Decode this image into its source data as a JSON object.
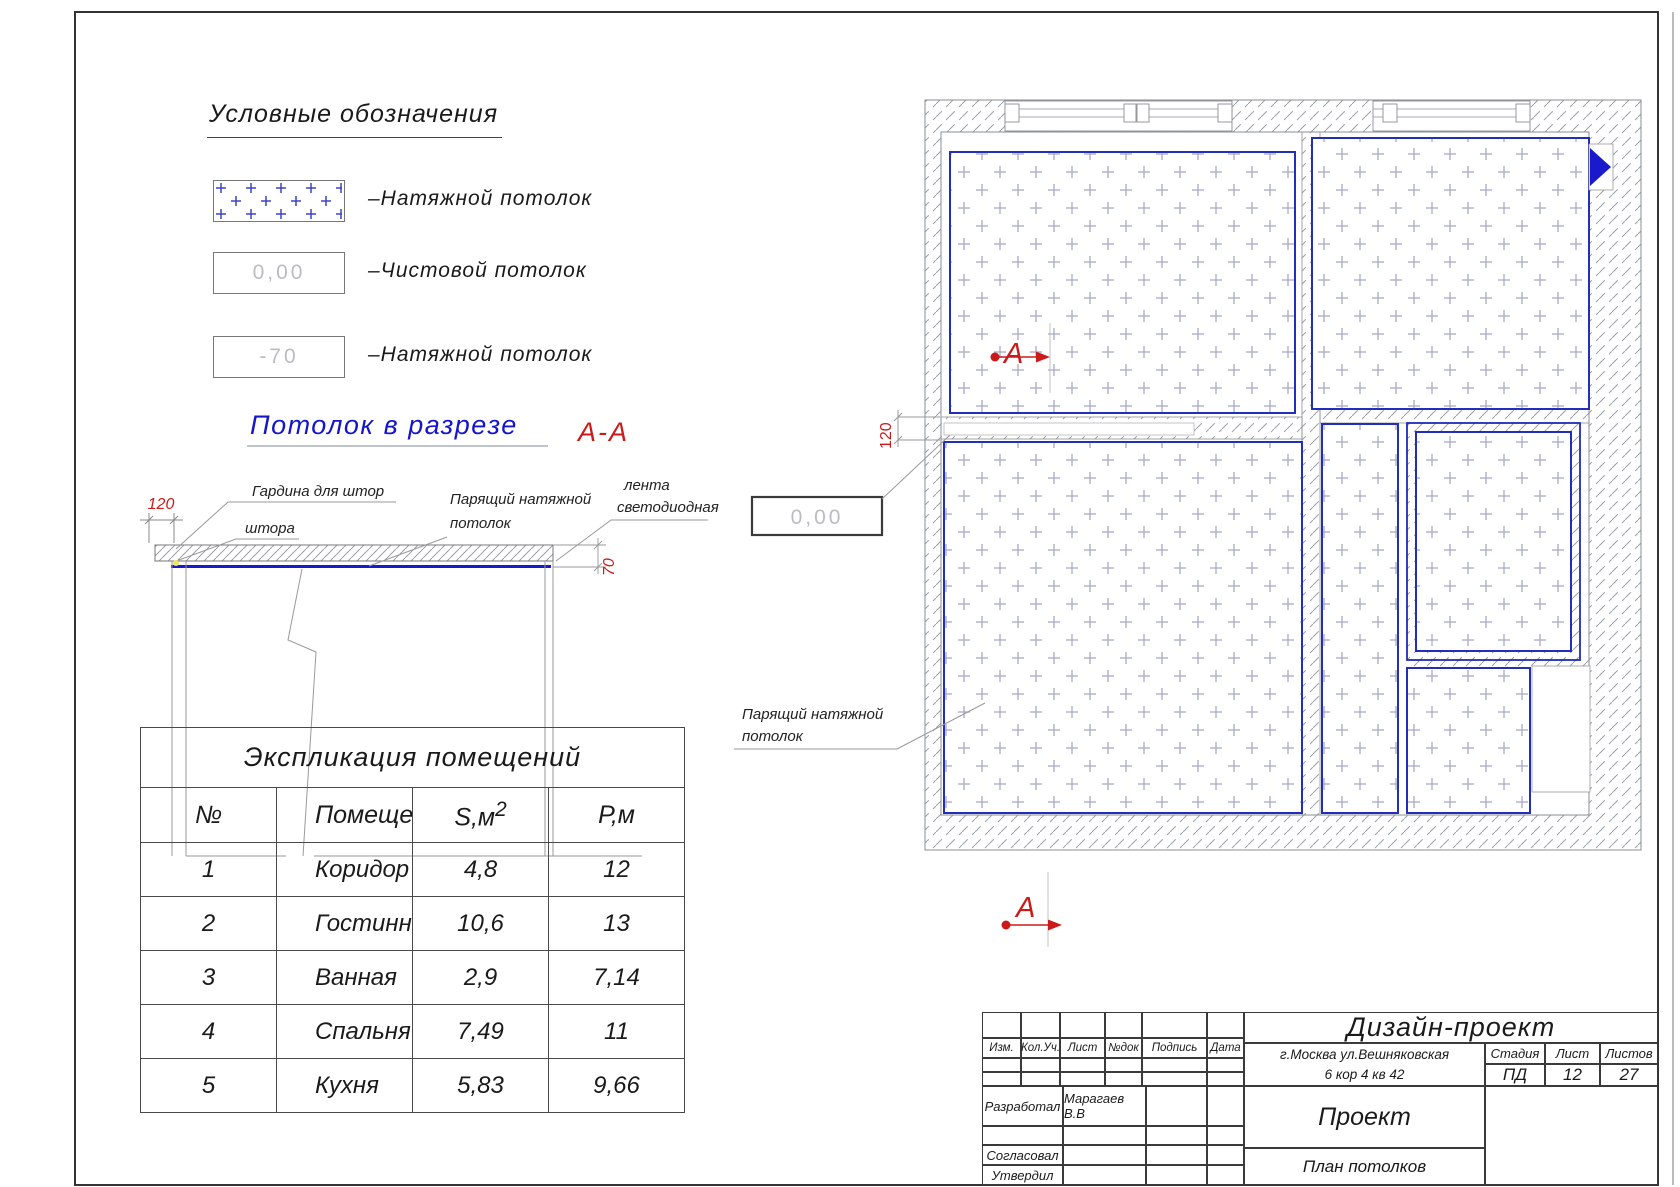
{
  "legend": {
    "title": "Условные обозначения",
    "items": [
      {
        "swatch": "plus-pattern",
        "label": "–Натяжной потолок"
      },
      {
        "swatch_text": "0,00",
        "label": "–Чистовой потолок"
      },
      {
        "swatch_text": "-70",
        "label": "–Натяжной потолок"
      }
    ]
  },
  "section": {
    "title": "Потолок в разрезе",
    "cut_label": "А-А",
    "dim_left": "120",
    "dim_right": "70",
    "labels": {
      "curtain": "Гардина для штор",
      "curtain_short": "штора",
      "floating_1": "Парящий натяжной",
      "floating_2": "потолок",
      "led_1": "лента",
      "led_2": "светодиодная"
    }
  },
  "plan": {
    "dim_gap": "120",
    "level_mark": "0,00",
    "callout_1": "Парящий натяжной",
    "callout_2": "потолок",
    "section_marker": "А"
  },
  "table": {
    "title": "Экспликация помещений",
    "headers": [
      "№",
      "Помещение",
      "S,м",
      "Р,м"
    ],
    "area_sup": "2",
    "rows": [
      [
        "1",
        "Коридор",
        "4,8",
        "12"
      ],
      [
        "2",
        "Гостинная",
        "10,6",
        "13"
      ],
      [
        "3",
        "Ванная",
        "2,9",
        "7,14"
      ],
      [
        "4",
        "Спальня",
        "7,49",
        "11"
      ],
      [
        "5",
        "Кухня",
        "5,83",
        "9,66"
      ]
    ]
  },
  "title_block": {
    "rev_cols": [
      "Изм.",
      "Кол.Уч.",
      "Лист",
      "№док",
      "Подпись",
      "Дата"
    ],
    "developed_label": "Разработал",
    "developed_by": "Марагаев В.В",
    "agreed_label": "Согласовал",
    "approved_label": "Утвердил",
    "project": "Дизайн-проект",
    "address_1": "г.Москва ул.Вешняковская",
    "address_2": "6 кор 4 кв 42",
    "stage_label": "Стадия",
    "sheet_label": "Лист",
    "sheets_label": "Листов",
    "stage": "ПД",
    "sheet": "12",
    "sheets": "27",
    "doc_type": "Проект",
    "drawing_name": "План потолков"
  },
  "colors": {
    "blue": "#1f2ab8",
    "red": "#cc1a1a"
  }
}
